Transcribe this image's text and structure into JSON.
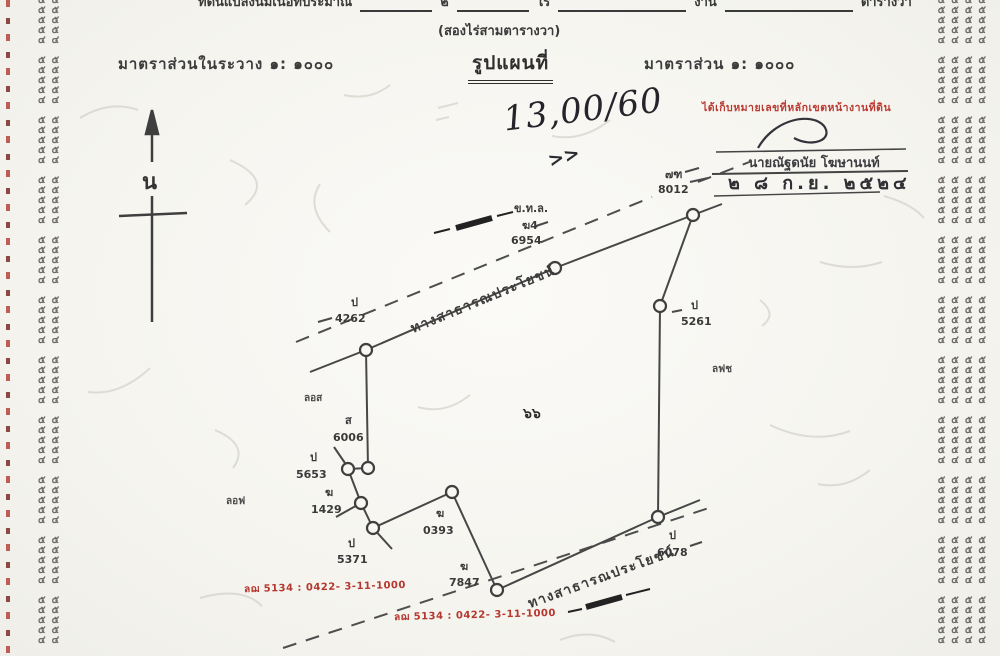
{
  "header": {
    "area_line": {
      "prefix": "ที่ดินแปลงนี้มีเนื้อที่ประมาณ",
      "rai_value": "๒",
      "rai_label": "ไร่",
      "ngan_label": "งาน",
      "wa_label": "ตารางวา"
    },
    "area_words": "(สองไร่สามตารางวา)",
    "scale_left": "มาตราส่วนในระวาง  ๑: ๑๐๐๐",
    "map_title": "รูปแผนที่",
    "scale_right": "มาตราส่วน  ๑: ๑๐๐๐"
  },
  "annotations": {
    "handwritten_number": "13,00/60",
    "handwritten_mark": ">>",
    "stamp_red": "ได้เก็บหมายเลขที่หลักเขตหน้างานที่ดิน",
    "officer_name": "นายณัฐดนัย  โฆษานนท์",
    "stamp_date": "๒ ๘ ก.ย. ๒๕๒๔",
    "ref_red_1": "ลฌ 5134 : 0422- 3-11-1000",
    "ref_red_2": "ลฌ 5134 : 0422- 3-11-1000"
  },
  "compass": {
    "north_label": "น"
  },
  "map": {
    "parcel_number": "๖๖",
    "road_top_label": "ทางสาธารณประโยชน์",
    "road_bottom_label": "ทางสาธารณประโยชน์",
    "road_code": {
      "line1": "ข.ท.ล.",
      "line2": "ฆ4",
      "line3": "6954"
    },
    "boundary_8012": {
      "prefix": "๗ฑ",
      "number": "8012"
    },
    "markers": {
      "m4262": {
        "prefix": "ป",
        "number": "4262"
      },
      "m5261": {
        "prefix": "ป",
        "number": "5261"
      },
      "m6006": {
        "prefix": "ส",
        "number": "6006"
      },
      "m5653": {
        "prefix": "ป",
        "number": "5653"
      },
      "m1429": {
        "prefix": "ฆ",
        "number": "1429"
      },
      "m5371": {
        "prefix": "ป",
        "number": "5371"
      },
      "m0393": {
        "prefix": "ฆ",
        "number": "0393"
      },
      "m7847": {
        "prefix": "ฆ",
        "number": "7847"
      },
      "m6078": {
        "prefix": "ป",
        "number": "6078"
      }
    },
    "adjacent_labels": {
      "a1": "ลอส",
      "a2": "ลอฟ",
      "a3": "ลฟช"
    }
  },
  "edges": {
    "right_unit": "๕๕๕๕\n๕๕๕๕\n๕๕๕๕\n๕๕๕๕\n๔๔๔๔\n ",
    "left_unit": "๕๕\n๕๕\n๕๕\n๕๕\n๔๔\n "
  },
  "colors": {
    "red_stamp": "#bb3a31",
    "ink": "#3a3a3a",
    "paper": "#f6f5f0"
  }
}
